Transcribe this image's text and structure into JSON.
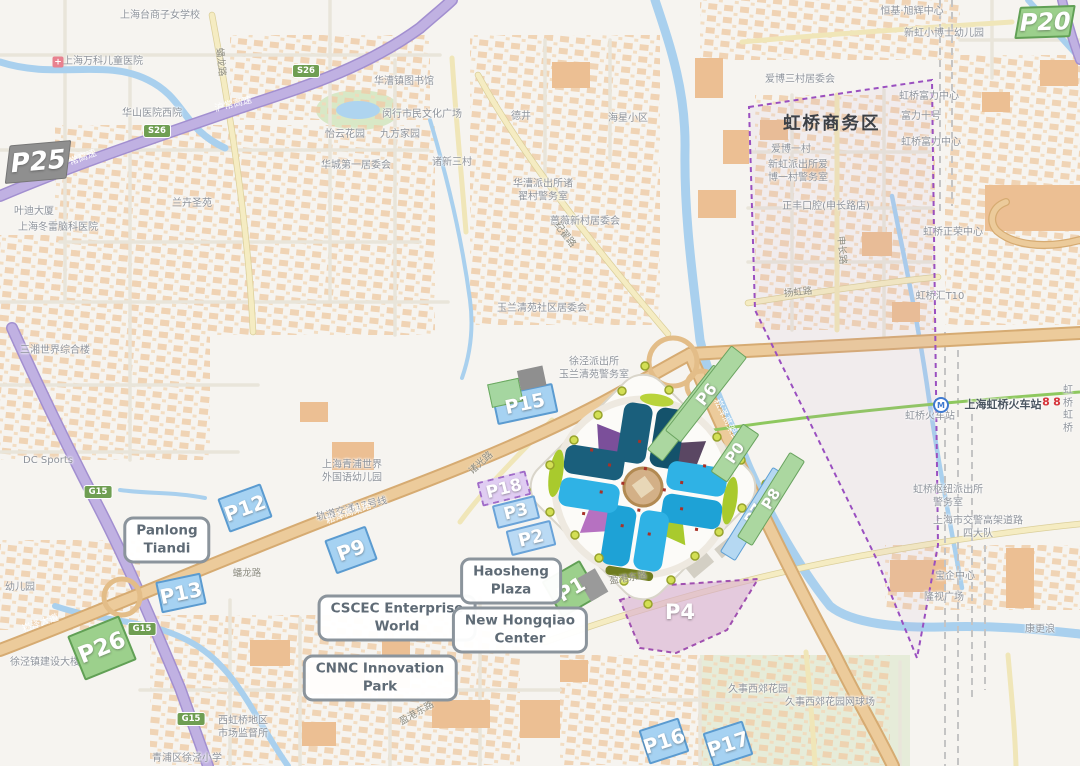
{
  "map": {
    "district_zone_label": "虹桥商务区",
    "parking_markers": [
      {
        "id": "P25",
        "label": "P25",
        "style": "gray",
        "x": 38,
        "y": 162,
        "w": 62,
        "h": 38,
        "rot": -5,
        "skew": -12,
        "fs": 26
      },
      {
        "id": "P20",
        "label": "P20",
        "style": "green",
        "x": 1045,
        "y": 22,
        "w": 56,
        "h": 32,
        "rot": -2,
        "skew": -12,
        "fs": 24
      },
      {
        "id": "P15",
        "label": "P15",
        "style": "blue p15",
        "x": 525,
        "y": 404,
        "w": 62,
        "h": 30,
        "rot": -12,
        "fs": 19
      },
      {
        "id": "P18",
        "label": "P18",
        "style": "lavender",
        "x": 504,
        "y": 488,
        "w": 50,
        "h": 25,
        "rot": -14,
        "fs": 17
      },
      {
        "id": "P3",
        "label": "P3",
        "style": "bluelight",
        "x": 516,
        "y": 512,
        "w": 44,
        "h": 24,
        "rot": -14,
        "fs": 17
      },
      {
        "id": "P2",
        "label": "P2",
        "style": "bluelight",
        "x": 531,
        "y": 538,
        "w": 46,
        "h": 26,
        "rot": -14,
        "fs": 18
      },
      {
        "id": "P1",
        "label": "P1",
        "style": "green p1",
        "x": 571,
        "y": 589,
        "w": 44,
        "h": 42,
        "rot": -30,
        "fs": 20
      },
      {
        "id": "P4",
        "label": "P4",
        "style": "arealabel",
        "x": 680,
        "y": 612,
        "w": 50,
        "h": 30,
        "rot": 0,
        "fs": 21
      },
      {
        "id": "P5",
        "label": "P5",
        "style": "strip-green",
        "x": 688,
        "y": 413,
        "w": 108,
        "h": 20,
        "rot": -52,
        "fs": 16
      },
      {
        "id": "P6",
        "label": "P6",
        "style": "strip-green",
        "x": 706,
        "y": 394,
        "w": 108,
        "h": 20,
        "rot": -52,
        "fs": 16
      },
      {
        "id": "P0",
        "label": "P0",
        "style": "strip-green",
        "x": 735,
        "y": 453,
        "w": 58,
        "h": 20,
        "rot": -56,
        "fs": 15
      },
      {
        "id": "P7",
        "label": "P7",
        "style": "strip-blue",
        "x": 754,
        "y": 514,
        "w": 100,
        "h": 18,
        "rot": -58,
        "fs": 15
      },
      {
        "id": "P8",
        "label": "P8",
        "style": "strip-green",
        "x": 771,
        "y": 499,
        "w": 100,
        "h": 18,
        "rot": -58,
        "fs": 15
      },
      {
        "id": "P9",
        "label": "P9",
        "style": "blue",
        "x": 351,
        "y": 550,
        "w": 44,
        "h": 36,
        "rot": -20,
        "fs": 20
      },
      {
        "id": "P12",
        "label": "P12",
        "style": "blue",
        "x": 245,
        "y": 508,
        "w": 46,
        "h": 36,
        "rot": -20,
        "fs": 20
      },
      {
        "id": "P13",
        "label": "P13",
        "style": "blue",
        "x": 181,
        "y": 593,
        "w": 46,
        "h": 32,
        "rot": -12,
        "fs": 20
      },
      {
        "id": "P16",
        "label": "P16",
        "style": "blue",
        "x": 664,
        "y": 741,
        "w": 42,
        "h": 36,
        "rot": -18,
        "fs": 20
      },
      {
        "id": "P17",
        "label": "P17",
        "style": "blue",
        "x": 728,
        "y": 744,
        "w": 42,
        "h": 36,
        "rot": -18,
        "fs": 20
      },
      {
        "id": "P26",
        "label": "P26",
        "style": "green",
        "x": 102,
        "y": 648,
        "w": 56,
        "h": 48,
        "rot": -22,
        "fs": 23
      }
    ],
    "place_cards": [
      {
        "id": "panlong-tiandi",
        "lines": [
          "Panlong",
          "Tiandi"
        ],
        "x": 167,
        "y": 540
      },
      {
        "id": "cscec-enterprise-world",
        "lines": [
          "CSCEC Enterprise",
          "World"
        ],
        "x": 397,
        "y": 618
      },
      {
        "id": "cnnc-innovation-park",
        "lines": [
          "CNNC Innovation",
          "Park"
        ],
        "x": 380,
        "y": 678
      },
      {
        "id": "haosheng-plaza",
        "lines": [
          "Haosheng",
          "Plaza"
        ],
        "x": 511,
        "y": 581
      },
      {
        "id": "new-hongqiao-center",
        "lines": [
          "New Hongqiao",
          "Center"
        ],
        "x": 520,
        "y": 630
      }
    ],
    "map_labels": [
      {
        "t": "上海台商子女学校",
        "x": 160,
        "y": 16
      },
      {
        "t": "上海万科儿童医院",
        "x": 103,
        "y": 62
      },
      {
        "t": "华漕镇图书馆",
        "x": 404,
        "y": 82
      },
      {
        "t": "华山医院西院",
        "x": 152,
        "y": 114
      },
      {
        "t": "闵行市民文化广场",
        "x": 422,
        "y": 115
      },
      {
        "t": "德井",
        "x": 521,
        "y": 117
      },
      {
        "t": "海星小区",
        "x": 628,
        "y": 119
      },
      {
        "t": "怡云花园",
        "x": 345,
        "y": 135
      },
      {
        "t": "九方家园",
        "x": 400,
        "y": 135
      },
      {
        "t": "诸新三村",
        "x": 452,
        "y": 163
      },
      {
        "t": "华城第一居委会",
        "x": 356,
        "y": 166
      },
      {
        "lines": [
          "华漕派出所诸",
          "翟村警务室"
        ],
        "x": 543,
        "y": 191
      },
      {
        "t": "蔷薇新村居委会",
        "x": 585,
        "y": 222
      },
      {
        "t": "叶迪大厦",
        "x": 34,
        "y": 212
      },
      {
        "t": "上海冬雷脑科医院",
        "x": 58,
        "y": 228
      },
      {
        "t": "兰卉圣苑",
        "x": 192,
        "y": 204
      },
      {
        "t": "三湘世界综合楼",
        "x": 55,
        "y": 351
      },
      {
        "t": "DC Sports",
        "x": 48,
        "y": 461
      },
      {
        "lines": [
          "上海青浦世界",
          "外国语幼儿园"
        ],
        "x": 352,
        "y": 472
      },
      {
        "t": "轨道交通17号线",
        "x": 352,
        "y": 510,
        "r": -14
      },
      {
        "t": "玉兰清苑社区居委会",
        "x": 542,
        "y": 309
      },
      {
        "lines": [
          "徐泾派出所",
          "玉兰清苑警务室"
        ],
        "x": 594,
        "y": 369
      },
      {
        "lines": [
          "西虹桥地区",
          "市场监督所"
        ],
        "x": 243,
        "y": 728
      },
      {
        "t": "青浦区徐泾小学",
        "x": 187,
        "y": 759
      },
      {
        "t": "徐泾镇建设大楼",
        "x": 45,
        "y": 663
      },
      {
        "t": "幼儿园",
        "x": 20,
        "y": 588
      },
      {
        "t": "久事西郊花园",
        "x": 758,
        "y": 690
      },
      {
        "t": "久事西郊花园网球场",
        "x": 830,
        "y": 703
      },
      {
        "t": "爱博三村居委会",
        "x": 800,
        "y": 80
      },
      {
        "t": "新虹小博士幼儿园",
        "x": 944,
        "y": 34
      },
      {
        "t": "恒基·旭辉中心",
        "x": 912,
        "y": 12
      },
      {
        "t": "虹桥富力中心",
        "x": 929,
        "y": 97
      },
      {
        "t": "富力十号",
        "x": 921,
        "y": 117
      },
      {
        "t": "虹桥富力中心",
        "x": 931,
        "y": 143
      },
      {
        "t": "爱博一村",
        "x": 791,
        "y": 150
      },
      {
        "lines": [
          "新虹派出所爱",
          "博一村警务室"
        ],
        "x": 798,
        "y": 172
      },
      {
        "t": "正丰口腔(申长路店)",
        "x": 826,
        "y": 207
      },
      {
        "t": "虹桥正荣中心",
        "x": 953,
        "y": 233
      },
      {
        "t": "虹桥汇T10",
        "x": 940,
        "y": 297
      },
      {
        "lines": [
          "虹桥枢纽派出所",
          "警务室"
        ],
        "x": 948,
        "y": 497
      },
      {
        "lines": [
          "上海市交警高架道路",
          "四大队"
        ],
        "x": 978,
        "y": 528
      },
      {
        "t": "上海虹桥火车站",
        "x": 1003,
        "y": 405,
        "v": "dark"
      },
      {
        "t": "虹桥火车站",
        "x": 930,
        "y": 417
      },
      {
        "lines": [
          "虹桥",
          "虹桥"
        ],
        "x": 1068,
        "y": 410
      },
      {
        "t": "宝企中心",
        "x": 955,
        "y": 577
      },
      {
        "t": "隆视广场",
        "x": 944,
        "y": 598
      },
      {
        "t": "康更浪",
        "x": 1040,
        "y": 630
      }
    ],
    "road_labels": [
      {
        "t": "沪常高速",
        "x": 78,
        "y": 158,
        "r": -21,
        "v": "white"
      },
      {
        "t": "沪常高速",
        "x": 233,
        "y": 103,
        "r": -14,
        "v": "white"
      },
      {
        "t": "崧泽大道",
        "x": 40,
        "y": 622,
        "r": -19,
        "v": "white"
      },
      {
        "t": "崧泽高架路",
        "x": 348,
        "y": 512,
        "r": -20,
        "v": "white"
      },
      {
        "t": "崧泽高架路",
        "x": 728,
        "y": 420,
        "r": 64,
        "v": "white"
      },
      {
        "t": "纪翟路",
        "x": 566,
        "y": 234,
        "r": 52,
        "v": "gray"
      },
      {
        "t": "蟠龙路",
        "x": 222,
        "y": 62,
        "r": 84,
        "v": "gray"
      },
      {
        "t": "蟠龙路",
        "x": 247,
        "y": 572,
        "r": 0,
        "v": "gray"
      },
      {
        "t": "诸光路",
        "x": 480,
        "y": 462,
        "r": -42,
        "v": "gray"
      },
      {
        "t": "盈港东路",
        "x": 628,
        "y": 577,
        "r": -9,
        "v": "gray"
      },
      {
        "t": "盈港东路",
        "x": 416,
        "y": 712,
        "r": -30,
        "v": "gray"
      },
      {
        "t": "扬虹路",
        "x": 798,
        "y": 291,
        "r": -6,
        "v": "gray"
      },
      {
        "t": "申长路",
        "x": 843,
        "y": 250,
        "r": 85,
        "v": "gray"
      }
    ],
    "badges": [
      {
        "t": "S26",
        "x": 157,
        "y": 131
      },
      {
        "t": "S26",
        "x": 306,
        "y": 71
      },
      {
        "t": "G15",
        "x": 98,
        "y": 492
      },
      {
        "t": "G15",
        "x": 142,
        "y": 629
      },
      {
        "t": "G15",
        "x": 191,
        "y": 719
      }
    ],
    "icons": [
      {
        "type": "hospital-icon",
        "glyph": "+",
        "x": 58,
        "y": 62
      },
      {
        "type": "metro-station-icon",
        "glyph": "M",
        "x": 941,
        "y": 405
      },
      {
        "type": "metro-logo-icon",
        "glyph": "8",
        "x": 1046,
        "y": 402
      },
      {
        "type": "metro-logo-icon",
        "glyph": "8",
        "x": 1057,
        "y": 402
      }
    ],
    "colors": {
      "marker_green": "#9cd08c",
      "marker_blue": "#a6d2f2",
      "marker_gray": "#8f8f8f",
      "marker_lavender": "#e0cdf2",
      "area_pink": "#d9aed1",
      "boundary_purple": "#9a4fc0",
      "venue_dark_teal": "#1a5f7c",
      "venue_light_cyan": "#2fb2e5",
      "highway_purple": "#c0b1e2",
      "elevated_tan": "#eccb9b",
      "water_blue": "#a9d0ee",
      "metro_green": "#8ec85e"
    }
  }
}
